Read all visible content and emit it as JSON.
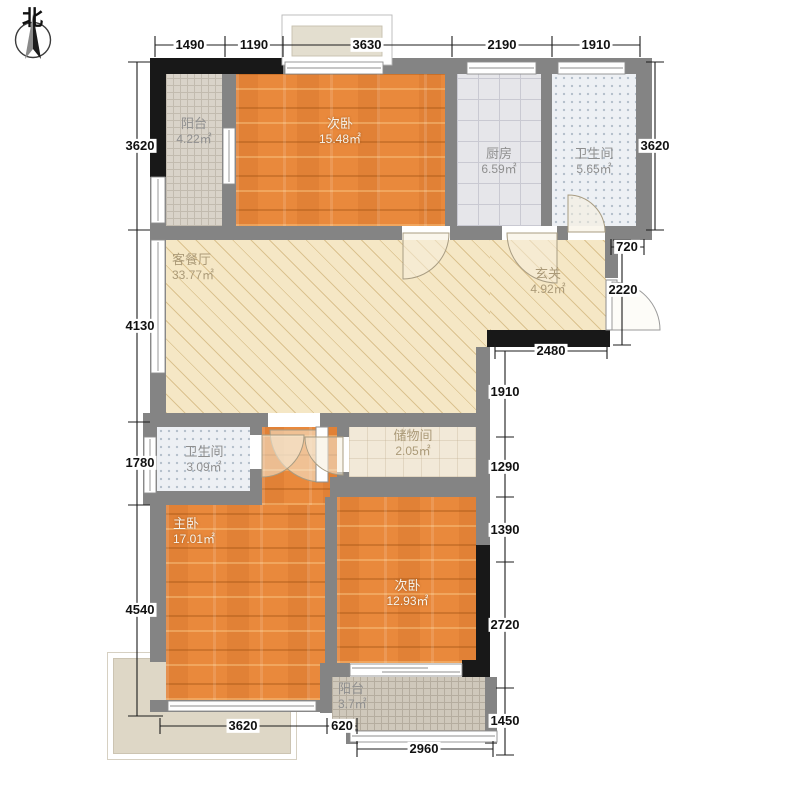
{
  "compass": {
    "label": "北"
  },
  "rooms": {
    "balcony_top": {
      "name": "阳台",
      "area": "4.22㎡"
    },
    "bedroom_top": {
      "name": "次卧",
      "area": "15.48㎡"
    },
    "kitchen": {
      "name": "厨房",
      "area": "6.59㎡"
    },
    "bath_top": {
      "name": "卫生间",
      "area": "5.65㎡"
    },
    "living": {
      "name": "客餐厅",
      "area": "33.77㎡"
    },
    "entry": {
      "name": "玄关",
      "area": "4.92㎡"
    },
    "bath_small": {
      "name": "卫生间",
      "area": "3.09㎡"
    },
    "storage": {
      "name": "储物间",
      "area": "2.05㎡"
    },
    "master": {
      "name": "主卧",
      "area": "17.01㎡"
    },
    "bedroom_bottom": {
      "name": "次卧",
      "area": "12.93㎡"
    },
    "balcony_bottom": {
      "name": "阳台",
      "area": "3.7㎡"
    }
  },
  "dims": {
    "top": [
      "1490",
      "1190",
      "3630",
      "2190",
      "1910"
    ],
    "left": [
      "3620",
      "4130",
      "1780",
      "4540"
    ],
    "right": [
      "3620",
      "720",
      "2220",
      "2480",
      "1910",
      "1290",
      "1390",
      "2720",
      "1450"
    ],
    "bottom": [
      "3620",
      "620",
      "2960"
    ]
  },
  "colors": {
    "wall_gray": "#848484",
    "wall_black": "#181818",
    "wood": "#e9893c",
    "living_beige": "#f5e7c5"
  }
}
